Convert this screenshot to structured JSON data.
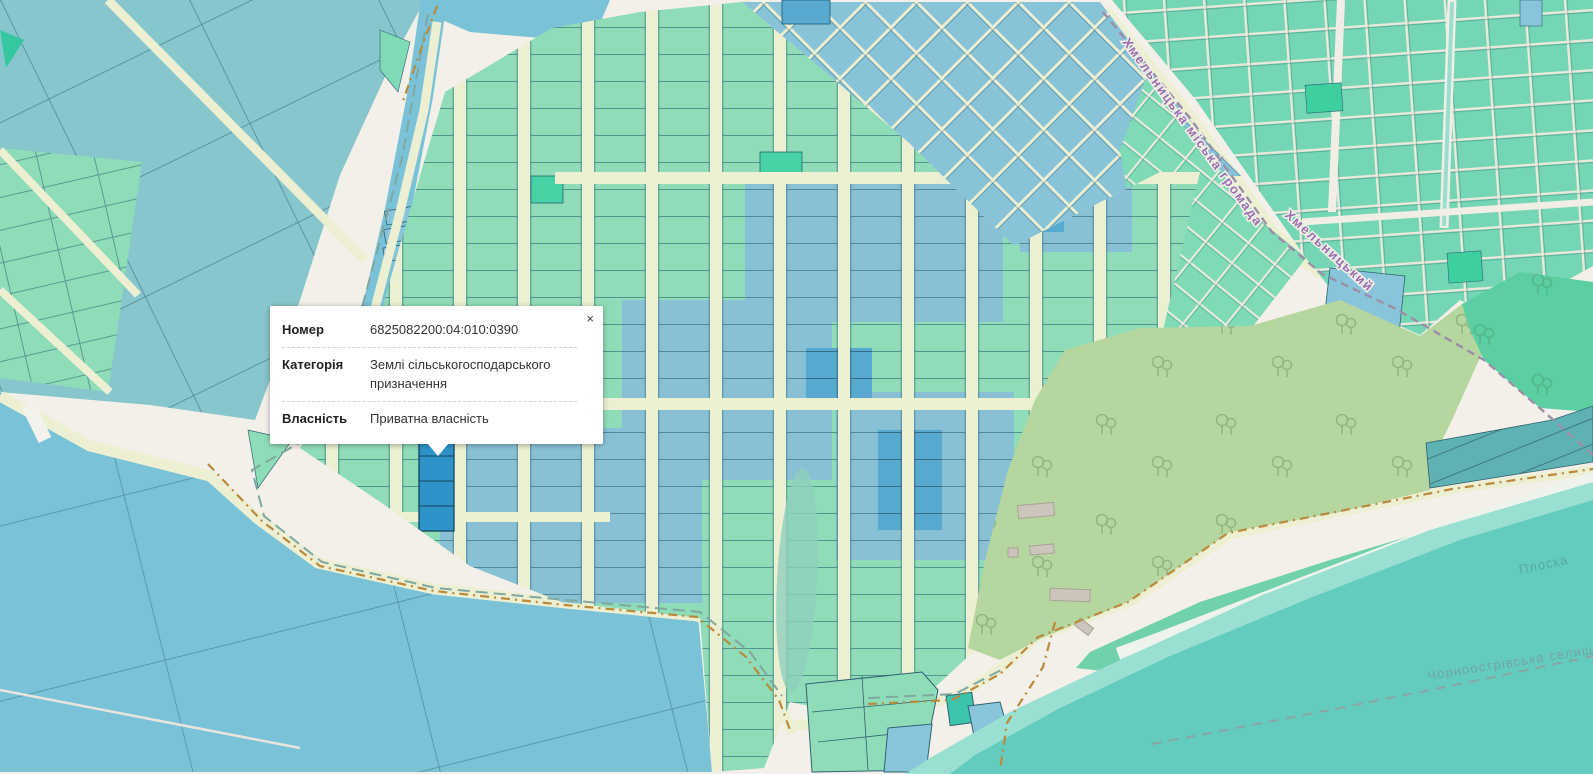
{
  "popup": {
    "close_label": "×",
    "rows": [
      {
        "label": "Номер",
        "value": "6825082200:04:010:0390"
      },
      {
        "label": "Категорія",
        "value": "Землі сільськогосподарського призначення"
      },
      {
        "label": "Власність",
        "value": "Приватна власність"
      }
    ]
  },
  "map_labels": {
    "hromada_boundary": "Хмельницька міська громада",
    "district": "Хмельницький",
    "river": "Плоска",
    "settlement_boundary": "Чорноострівська селищна гр"
  },
  "selected_parcel": {
    "cadastral_number": "6825082200:04:010:0390",
    "highlight_color": "#2e93c9"
  },
  "colors": {
    "parcel_green": "#8fdcb8",
    "parcel_blue": "#88c0d6",
    "parcel_teal": "#74d6b4",
    "field_teal": "#87c6cc",
    "water_blue": "#7ac2d7",
    "water_teal": "#63ccbe",
    "forest_green": "#b6d6a0",
    "road_cream": "#edefd2",
    "boundary_purple": "#9b8fa8",
    "track_brown": "#b98a3c"
  }
}
